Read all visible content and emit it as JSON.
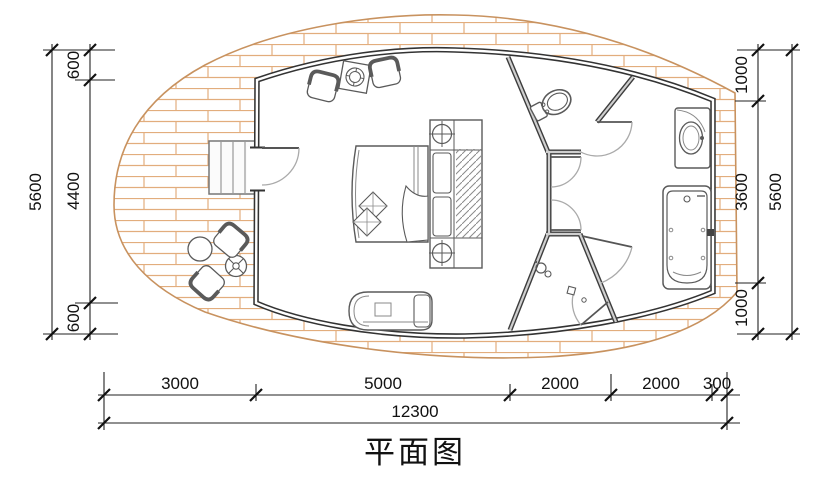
{
  "title": {
    "text": "平面图"
  },
  "dimensions": {
    "left": {
      "overall": "5600",
      "segments": [
        "600",
        "4400",
        "600"
      ]
    },
    "right": {
      "overall": "5600",
      "segments": [
        "1000",
        "3600",
        "1000"
      ]
    },
    "bottom": {
      "overall": "12300",
      "segments": [
        "3000",
        "5000",
        "2000",
        "2000",
        "300"
      ]
    }
  },
  "colors": {
    "brick_hatch": "#e2ad7d",
    "deck_outline": "#c8925f",
    "wall": "#333333",
    "partition_core": "#cfcfcf",
    "dimension_line": "#1a1a1a",
    "furniture_line": "#5a5a5a"
  },
  "icons": {
    "plan_furniture": [
      "double-bed",
      "wardrobe-with-hangers",
      "ceiling-light-symbol",
      "armchair",
      "coffee-table",
      "sofa-chaise",
      "toilet",
      "wash-basin",
      "bathtub",
      "shower-head",
      "floor-drain",
      "entry-steps",
      "outdoor-chair",
      "round-table",
      "parasol-table"
    ]
  }
}
